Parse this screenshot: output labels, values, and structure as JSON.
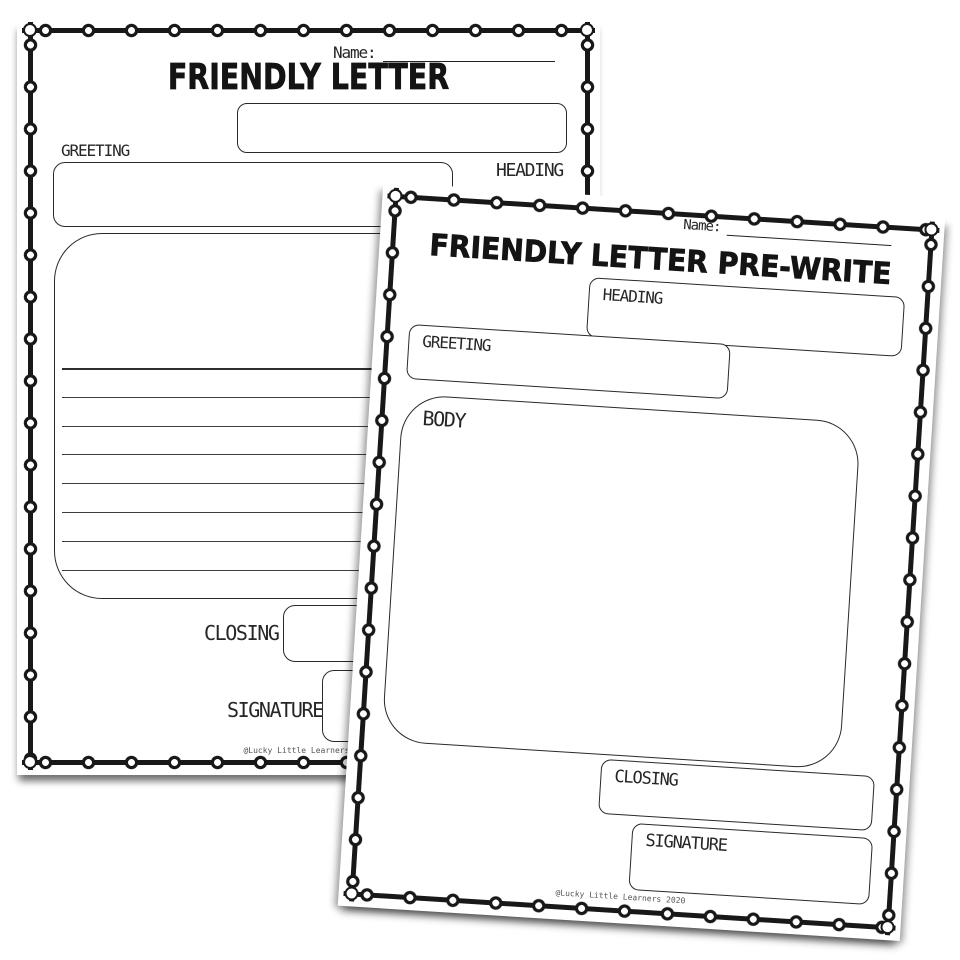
{
  "back_page": {
    "name_label": "Name:",
    "title": "FRIENDLY LETTER",
    "heading_label": "HEADING",
    "greeting_label": "GREETING",
    "closing_label": "CLOSING",
    "signature_label": "SIGNATURE",
    "credit": "@Lucky Little Learners 2020",
    "body_line_count": 8
  },
  "front_page": {
    "name_label": "Name:",
    "title": "FRIENDLY LETTER PRE-WRITE",
    "heading_label": "HEADING",
    "greeting_label": "GREETING",
    "body_label": "BODY",
    "closing_label": "CLOSING",
    "signature_label": "SIGNATURE",
    "credit": "@Lucky Little Learners 2020"
  },
  "colors": {
    "ink": "#181818",
    "paper": "#ffffff"
  }
}
